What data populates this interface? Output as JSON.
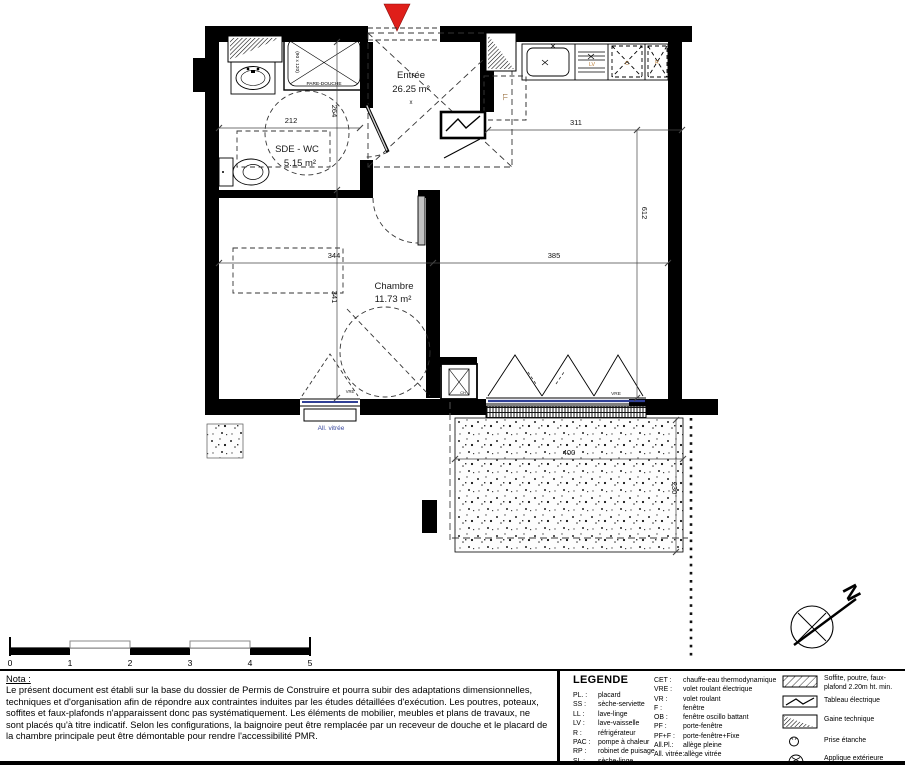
{
  "plan": {
    "entrance_arrow_color": "#df1f1a",
    "rooms": {
      "entree": {
        "name": "Entrée",
        "area": "26.25 m²"
      },
      "sde_wc": {
        "name": "SDE - WC",
        "area": "5.15 m²"
      },
      "chambre": {
        "name": "Chambre",
        "area": "11.73 m²"
      },
      "terrasse": {
        "name": "Terrasse",
        "area": "9.20 m²"
      }
    },
    "fixtures": {
      "pare_douche": "PARE-DOUCHE",
      "shower_size": "(90 x 120)",
      "washer": "LL",
      "dishwasher": "LV",
      "cooker": "C",
      "fridge": "R",
      "water_heater": "CH",
      "clearance_x": "x",
      "appliance_text_color": "#b5772f"
    },
    "windows": {
      "vre": "VRE",
      "all_vitree": "All. vitrée",
      "glazing_color": "#2f3f96"
    },
    "dimensions": {
      "sde_width": "212",
      "sde_depth": "264",
      "kitchen_width": "311",
      "sejour_depth": "612",
      "chambre_width": "344",
      "chambre_depth": "341",
      "sejour_width": "385",
      "terrasse_width": "400",
      "terrasse_depth": "230"
    },
    "north_label": "N"
  },
  "scale_bar": {
    "ticks": [
      "0",
      "1",
      "2",
      "3",
      "4",
      "5"
    ]
  },
  "nota": {
    "title": "Nota :",
    "body": "Le présent document est établi sur la base du dossier de Permis de Construire et pourra subir des adaptations dimensionnelles, techniques et d'organisation afin de répondre aux contraintes induites par les études détaillées d'exécution. Les poutres, poteaux, soffites et faux-plafonds n'apparaissent donc pas systématiquement. Les éléments de mobilier, meubles et plans de travaux, ne sont placés qu'à titre indicatif. Selon les configurations, la baignoire peut être remplacée par un receveur de douche et le placard de la chambre principale peut être démontable pour rendre l'accessibilité PMR."
  },
  "legend": {
    "title": "LEGENDE",
    "col1": [
      {
        "abbr": "PL. :",
        "label": "placard"
      },
      {
        "abbr": "SS :",
        "label": "sèche-serviette"
      },
      {
        "abbr": "LL :",
        "label": "lave-linge"
      },
      {
        "abbr": "LV :",
        "label": "lave-vaisselle"
      },
      {
        "abbr": "R :",
        "label": "réfrigérateur"
      },
      {
        "abbr": "PAC :",
        "label": "pompe à chaleur"
      },
      {
        "abbr": "RP :",
        "label": "robinet de puisage"
      },
      {
        "abbr": "SL :",
        "label": "sèche-linge"
      }
    ],
    "col2": [
      {
        "abbr": "CET :",
        "label": "chauffe-eau thermodynamique"
      },
      {
        "abbr": "VRE :",
        "label": "volet roulant électrique"
      },
      {
        "abbr": "VR :",
        "label": "volet roulant"
      },
      {
        "abbr": "F :",
        "label": "fenêtre"
      },
      {
        "abbr": "OB :",
        "label": "fenêtre oscillo battant"
      },
      {
        "abbr": "PF :",
        "label": "porte-fenêtre"
      },
      {
        "abbr": "PF+F :",
        "label": "porte-fenêtre+Fixe"
      },
      {
        "abbr": "All.Pl.:",
        "label": "allège pleine"
      },
      {
        "abbr": "All. vitrée:",
        "label": "allège vitrée"
      }
    ],
    "icons": [
      {
        "name": "soffit-hatch",
        "label": "Soffite, poutre, faux-plafond 2.20m ht. min."
      },
      {
        "name": "electrical-panel",
        "label": "Tableau électrique"
      },
      {
        "name": "technical-duct",
        "label": "Gaine technique"
      },
      {
        "name": "sealed-socket",
        "label": "Prise étanche"
      },
      {
        "name": "outdoor-sconce",
        "label": "Applique extérieure"
      }
    ]
  }
}
